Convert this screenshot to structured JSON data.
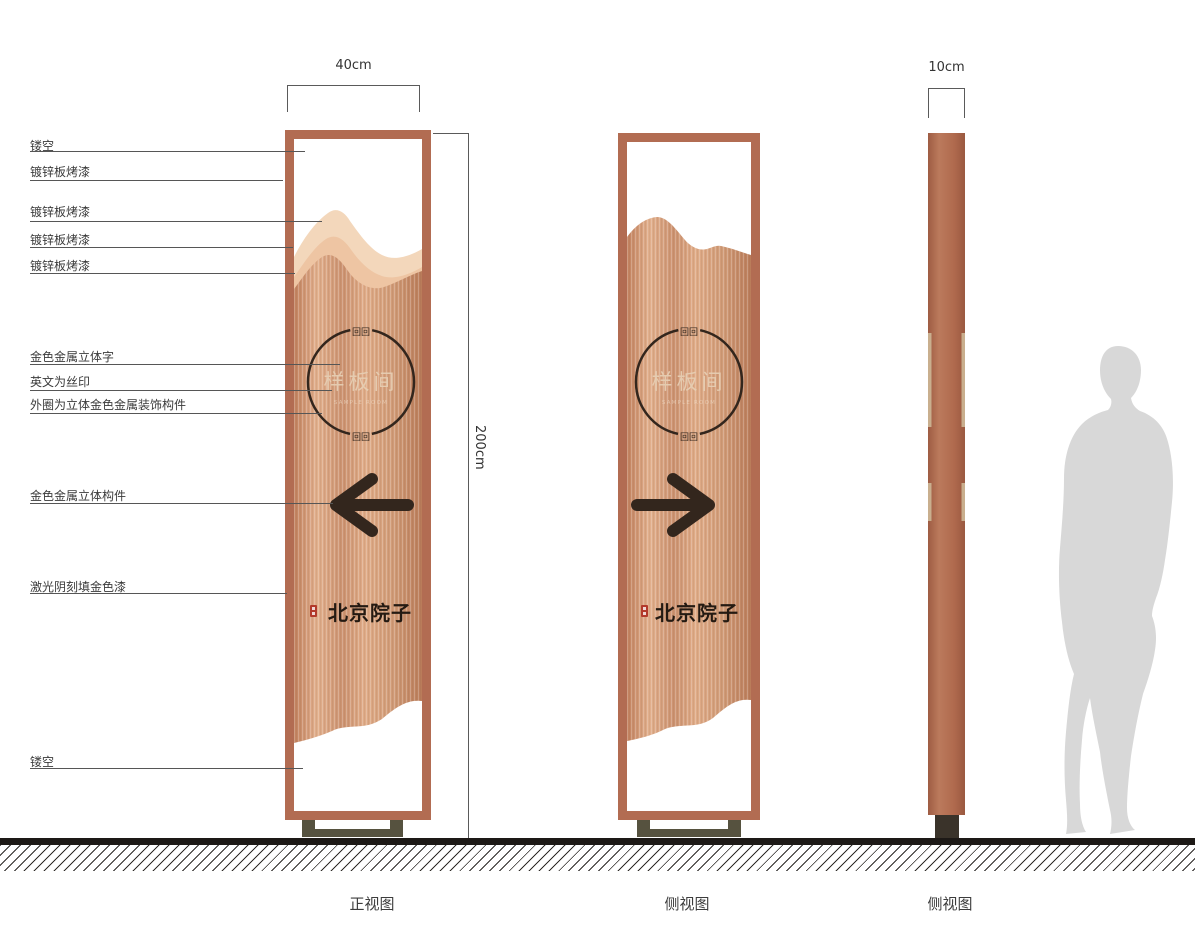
{
  "callouts": [
    {
      "label": "镂空"
    },
    {
      "label": "镀锌板烤漆"
    },
    {
      "label": "镀锌板烤漆"
    },
    {
      "label": "镀锌板烤漆"
    },
    {
      "label": "镀锌板烤漆"
    },
    {
      "label": "金色金属立体字"
    },
    {
      "label": "英文为丝印"
    },
    {
      "label": "外圈为立体金色金属装饰构件"
    },
    {
      "label": "金色金属立体构件"
    },
    {
      "label": "激光阴刻填金色漆"
    },
    {
      "label": "镂空"
    }
  ],
  "dimensions": {
    "front_width": "40cm",
    "height": "200cm",
    "side_width": "10cm"
  },
  "views": [
    {
      "label": "正视图"
    },
    {
      "label": "侧视图"
    },
    {
      "label": "侧视图"
    }
  ],
  "sign": {
    "room_name": "样板间",
    "room_name_en": "SAMPLE ROOM",
    "brand_name": "北京院子",
    "ornament_glyphs": "回回"
  },
  "colors": {
    "frame_copper": "#b26c52",
    "panel_copper_light": "#e2b08d",
    "panel_copper_dark": "#ba7c5a",
    "mountain_back": "#f3d7bb",
    "mountain_mid": "#eec5a3",
    "ink_dark": "#33261d",
    "gold_text": "#e7cfb4",
    "seal_red": "#b23a2b",
    "base_olive": "#56523f",
    "ground_black": "#1d1916",
    "human_gray": "#d8d8d8"
  }
}
